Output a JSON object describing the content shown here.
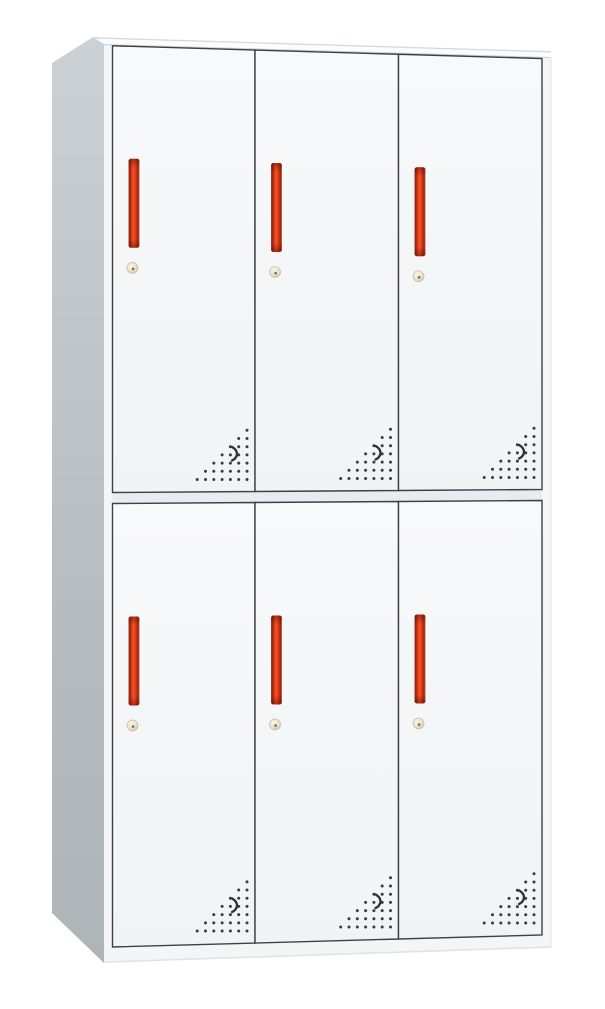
{
  "scene": {
    "type": "product-photo",
    "alt": "White steel locker cabinet with six doors in two rows of three; each door has a vertical red recessed handle, a round brass cam lock and a triangular pattern of perforated vent holes in its lower right corner",
    "background": "#ffffff",
    "canvas": {
      "width": 605,
      "height": 1009
    }
  },
  "cabinet": {
    "grid": {
      "rows": 2,
      "columns": 3,
      "door_count": 6
    },
    "colors": {
      "side_panel_top": "#cbd1d5",
      "side_panel_bottom": "#aeb5b9",
      "top_surface": "#fbfcfd",
      "top_edge_line": "#d3d8db",
      "front_face": "#f3f5f7",
      "front_chamfer_line": "#c9ced2",
      "door_face": "#f8f9fb",
      "door_face_low": "#f1f3f5",
      "door_outline": "#3e4144",
      "divider_gap": "#e9ecee",
      "base_edge": "#dfe3e6",
      "right_edge": "#e2e6e9",
      "handle_end_shade": "rgba(70,10,0,0.45)",
      "lock_rim": "#c9c0ab",
      "lock_pin": "#7a6b4f",
      "vent_dot": "#3a3d40",
      "vent_crescent": "#2e3134"
    },
    "gradients": {
      "side": {
        "colors": [
          "#cbd1d5",
          "#b8bec2",
          "#aeb5b9"
        ],
        "offsets": [
          0,
          0.55,
          1
        ]
      },
      "door": {
        "colors": [
          "#f8f9fb",
          "#f1f3f5"
        ],
        "offsets": [
          0,
          1
        ]
      },
      "handle": {
        "colors": [
          "#b14a38",
          "#8f1d0c",
          "#e8431a",
          "#f1512a",
          "#d63c14",
          "#9e220d",
          "#cf7763"
        ],
        "offsets": [
          0,
          0.1,
          0.33,
          0.5,
          0.66,
          0.88,
          1
        ]
      },
      "lock": {
        "colors": [
          "#f8f3e6",
          "#e9e1cc",
          "#cfc5ad"
        ],
        "offsets": [
          0,
          0.6,
          1
        ]
      }
    },
    "geometry": {
      "side": [
        [
          52,
          63
        ],
        [
          93,
          37
        ],
        [
          104,
          44
        ],
        [
          104,
          963
        ],
        [
          52,
          913
        ]
      ],
      "top": [
        [
          93,
          37
        ],
        [
          551,
          51
        ],
        [
          551,
          57
        ],
        [
          104,
          44
        ]
      ],
      "front": [
        [
          104,
          44
        ],
        [
          551,
          57
        ],
        [
          551,
          948
        ],
        [
          104,
          963
        ]
      ],
      "door_frame": {
        "x_left": 112.5,
        "x_right": 542,
        "col_edges": [
          112.5,
          255,
          398.5,
          542
        ]
      },
      "lines": {
        "top": [
          45.8,
          58.5
        ],
        "row1_bottom": [
          492.5,
          489.5
        ],
        "row2_top": [
          503.5,
          500.5
        ],
        "bottom": [
          947,
          935
        ]
      },
      "top_back_edge": [
        [
          93,
          37.8
        ],
        [
          551,
          51.8
        ]
      ],
      "base_bottom_edge": [
        [
          104,
          962
        ],
        [
          551,
          947
        ]
      ]
    },
    "door_parts": {
      "handle": {
        "offset_x": 16,
        "offset_y": 113,
        "width": 11,
        "height": 89,
        "radius": 2.5
      },
      "lock": {
        "offset_x": 20,
        "offset_y": 222,
        "radius": 5.5,
        "pin_radius": 1.3
      },
      "vent": {
        "right_margin": 8,
        "bottom_margin": 12,
        "rows": 7,
        "dx": 8.3,
        "dy": 8.2,
        "dot_radius": 1.5,
        "crescent_offset_x": 13,
        "crescent_offset_y": 26
      }
    }
  }
}
